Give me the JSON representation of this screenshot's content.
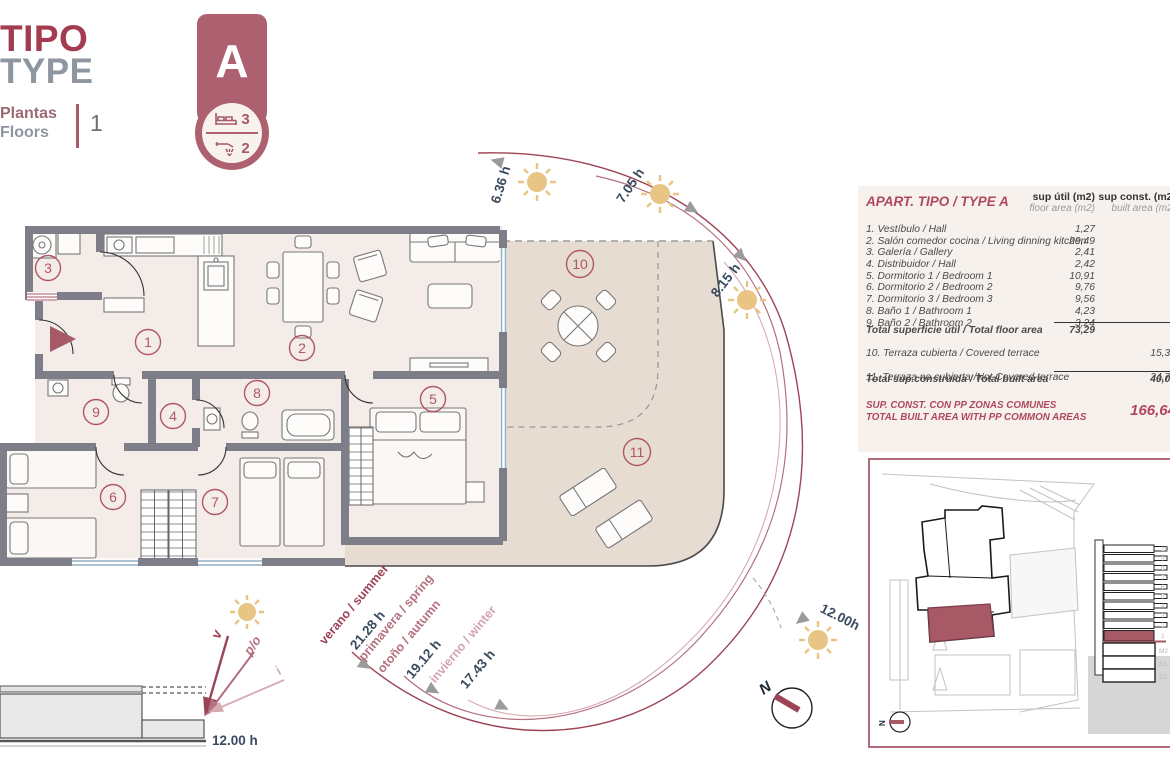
{
  "colors": {
    "accent": "#a75966",
    "dark_red": "#9c4456",
    "rose": "#b4717f",
    "light_pink": "#d8abb4",
    "navy": "#3a4a5f",
    "sun": "#e8c584",
    "wall": "#7e7e88",
    "terrace": "#e6dcd2",
    "floor": "#f3ece8"
  },
  "header": {
    "title_es": "TIPO",
    "title_en": "TYPE",
    "plantas": "Plantas",
    "floors": "Floors",
    "floors_value": "1"
  },
  "badge": {
    "letter": "A",
    "beds": "3",
    "baths": "2"
  },
  "plan": {
    "room_numbers": [
      "1",
      "2",
      "3",
      "4",
      "5",
      "6",
      "7",
      "8",
      "9",
      "10",
      "11"
    ]
  },
  "sun": {
    "hours": [
      "6.36 h",
      "7.05 h",
      "8.15 h",
      "12.00h"
    ],
    "seasons": [
      {
        "line1": "verano / summer",
        "hours": "21.28 h"
      },
      {
        "line1": "primavera / spring",
        "line2": "otoño / autumn",
        "hours": "19.12 h"
      },
      {
        "line1": "invierno / winter",
        "hours": "17.43 h"
      }
    ],
    "section": {
      "v": "v",
      "po": "p/o",
      "i": "i",
      "noon": "12.00 h"
    },
    "north": "N"
  },
  "area_table": {
    "title": "APART. TIPO / TYPE A",
    "columns": {
      "util_top": "sup útil (m2)",
      "util_sub": "floor area (m2)",
      "const_top": "sup const. (m2)",
      "const_sub": "built area (m2)"
    },
    "rows": [
      {
        "label": "1. Vestíbulo / Hall",
        "util": "1,27"
      },
      {
        "label": "2. Salón comedor cocina / Living dinning kitchen",
        "util": "29,49"
      },
      {
        "label": "3. Galería / Gallery",
        "util": "2,41"
      },
      {
        "label": "4. Distribuidor / Hall",
        "util": "2,42"
      },
      {
        "label": "5. Dormitorio 1 / Bedroom 1",
        "util": "10,91"
      },
      {
        "label": "6. Dormitorio 2 / Bedroom 2",
        "util": "9,76"
      },
      {
        "label": "7. Dormitorio 3 / Bedroom 3",
        "util": "9,56"
      },
      {
        "label": "8. Baño 1 / Bathroom 1",
        "util": "4,23"
      },
      {
        "label": "9. Baño 2 / Bathroom 2",
        "util": "3,24"
      }
    ],
    "total_util": {
      "label": "Total superficie útil / Total floor area",
      "value": "73,29"
    },
    "const_rows": [
      {
        "label": "10. Terraza cubierta / Covered terrace",
        "value": "15,32"
      },
      {
        "label": "11. Terraza no cubierta /Not Covered terrace",
        "value": "24,74"
      }
    ],
    "total_const": {
      "label": "Total sup.construida / Total built area",
      "value": "40,06"
    },
    "grand": {
      "line1": "SUP. CONST. CON PP ZONAS COMUNES",
      "line2": "TOTAL BUILT AREA WITH PP COMMON AREAS",
      "value": "166,64"
    }
  },
  "siteplan": {
    "floors": [
      "10",
      "9",
      "8",
      "7",
      "6",
      "5",
      "4",
      "3",
      "2",
      "1",
      "M2",
      "S1",
      "S2"
    ],
    "north": "N"
  }
}
